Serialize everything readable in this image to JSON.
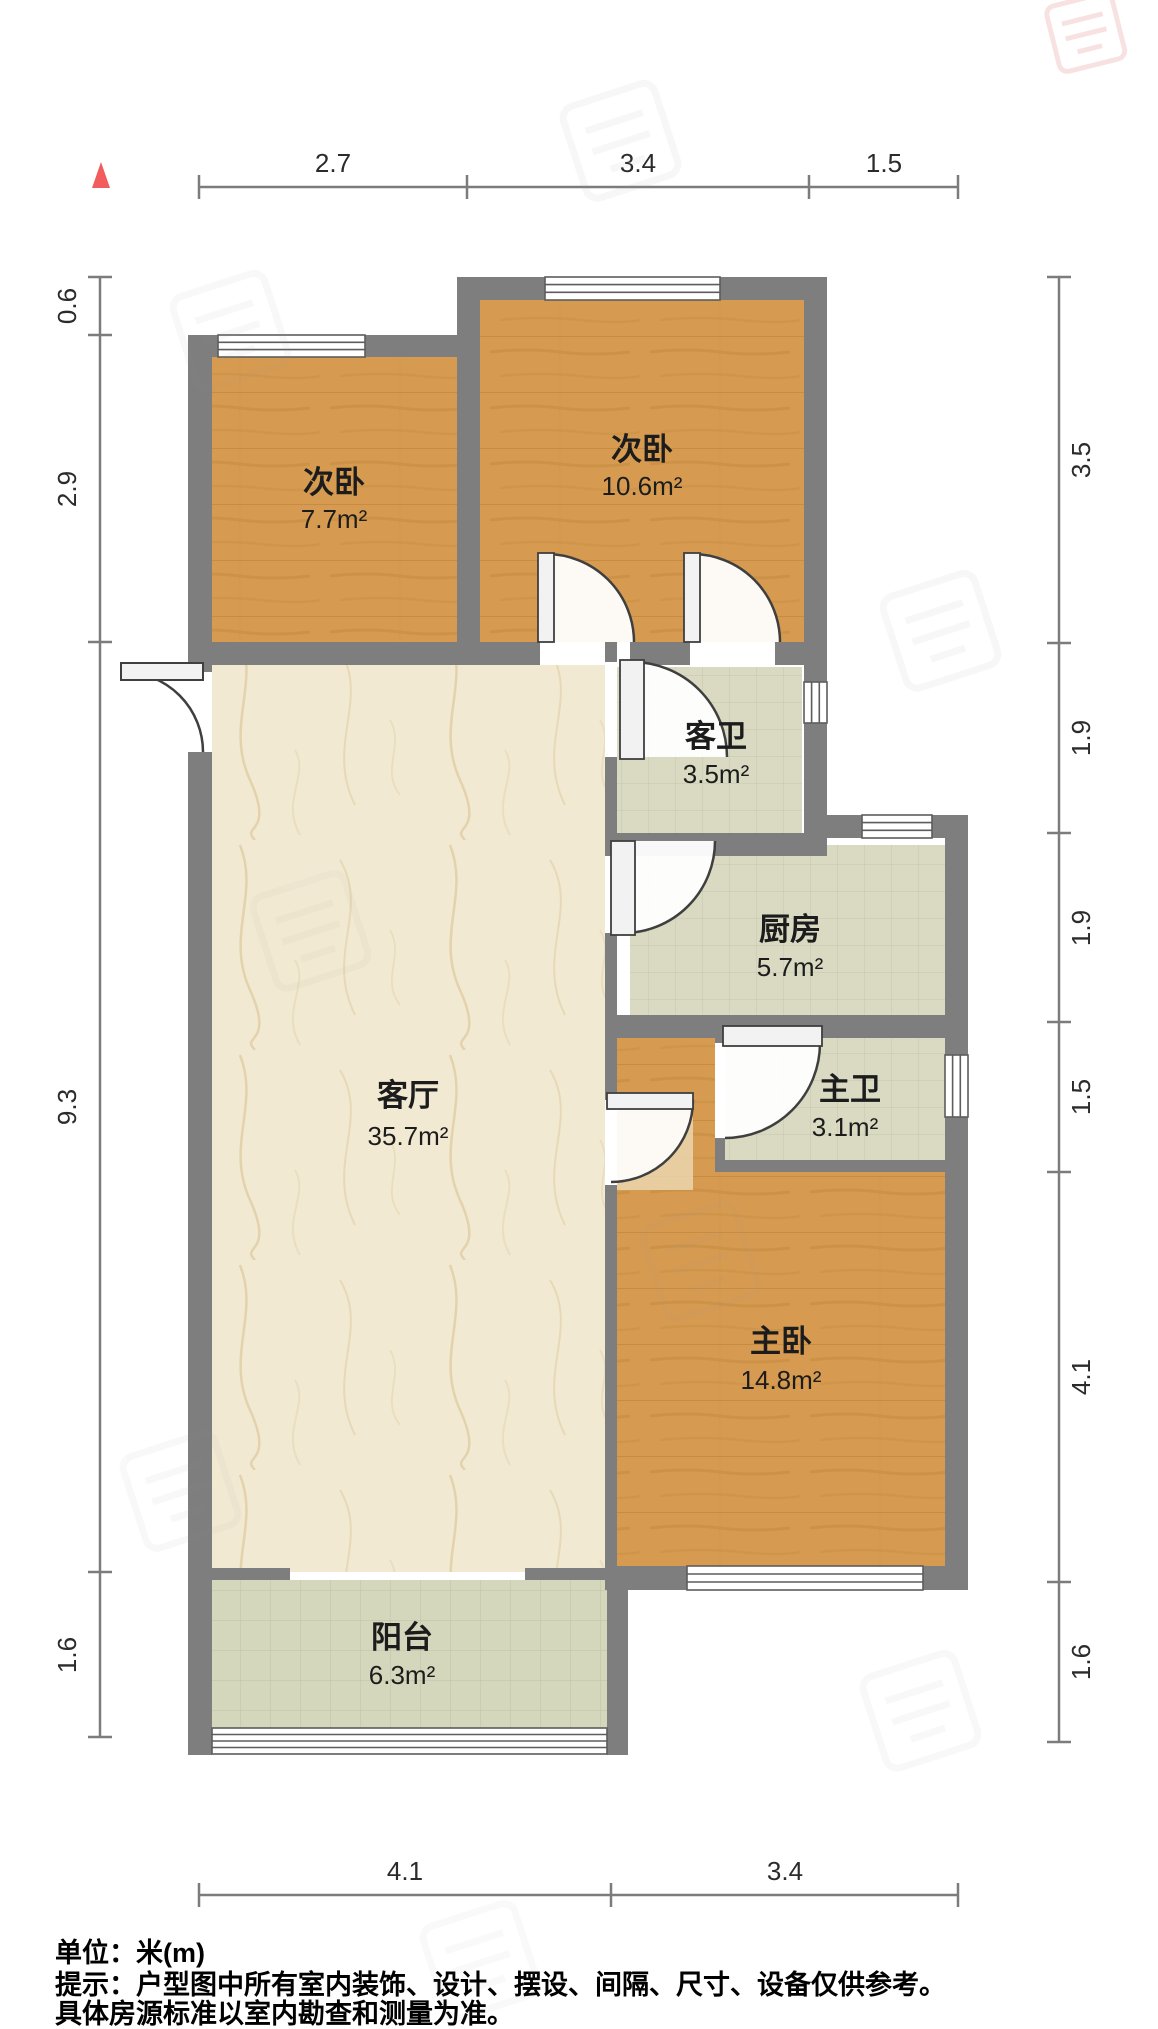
{
  "plan": {
    "type": "floor-plan",
    "unit_note": "单位：米(m)",
    "disclaimer_line1": "提示：户型图中所有室内装饰、设计、摆设、间隔、尺寸、设备仅供参考。",
    "disclaimer_line2": "具体房源标准以室内勘查和测量为准。"
  },
  "rooms": {
    "bedroom_small": {
      "name": "次卧",
      "area": "7.7m²"
    },
    "bedroom_large": {
      "name": "次卧",
      "area": "10.6m²"
    },
    "guest_bath": {
      "name": "客卫",
      "area": "3.5m²"
    },
    "kitchen": {
      "name": "厨房",
      "area": "5.7m²"
    },
    "master_bath": {
      "name": "主卫",
      "area": "3.1m²"
    },
    "living_room": {
      "name": "客厅",
      "area": "35.7m²"
    },
    "master_bedroom": {
      "name": "主卧",
      "area": "14.8m²"
    },
    "balcony": {
      "name": "阳台",
      "area": "6.3m²"
    }
  },
  "dimensions": {
    "top": [
      "2.7",
      "3.4",
      "1.5"
    ],
    "left": [
      "0.6",
      "2.9",
      "9.3",
      "1.6"
    ],
    "right": [
      "3.5",
      "1.9",
      "1.9",
      "1.5",
      "4.1",
      "1.6"
    ],
    "bottom": [
      "4.1",
      "3.4"
    ]
  },
  "colors": {
    "wall": "#7e7e7e",
    "wood_floor": "#d69b50",
    "marble_floor": "#f2e9d2",
    "tile_floor": "#dadac2",
    "balcony_tile": "#d5d7bc",
    "north_marker": "#f25c5c",
    "dimension_line": "#7c7c7c"
  }
}
